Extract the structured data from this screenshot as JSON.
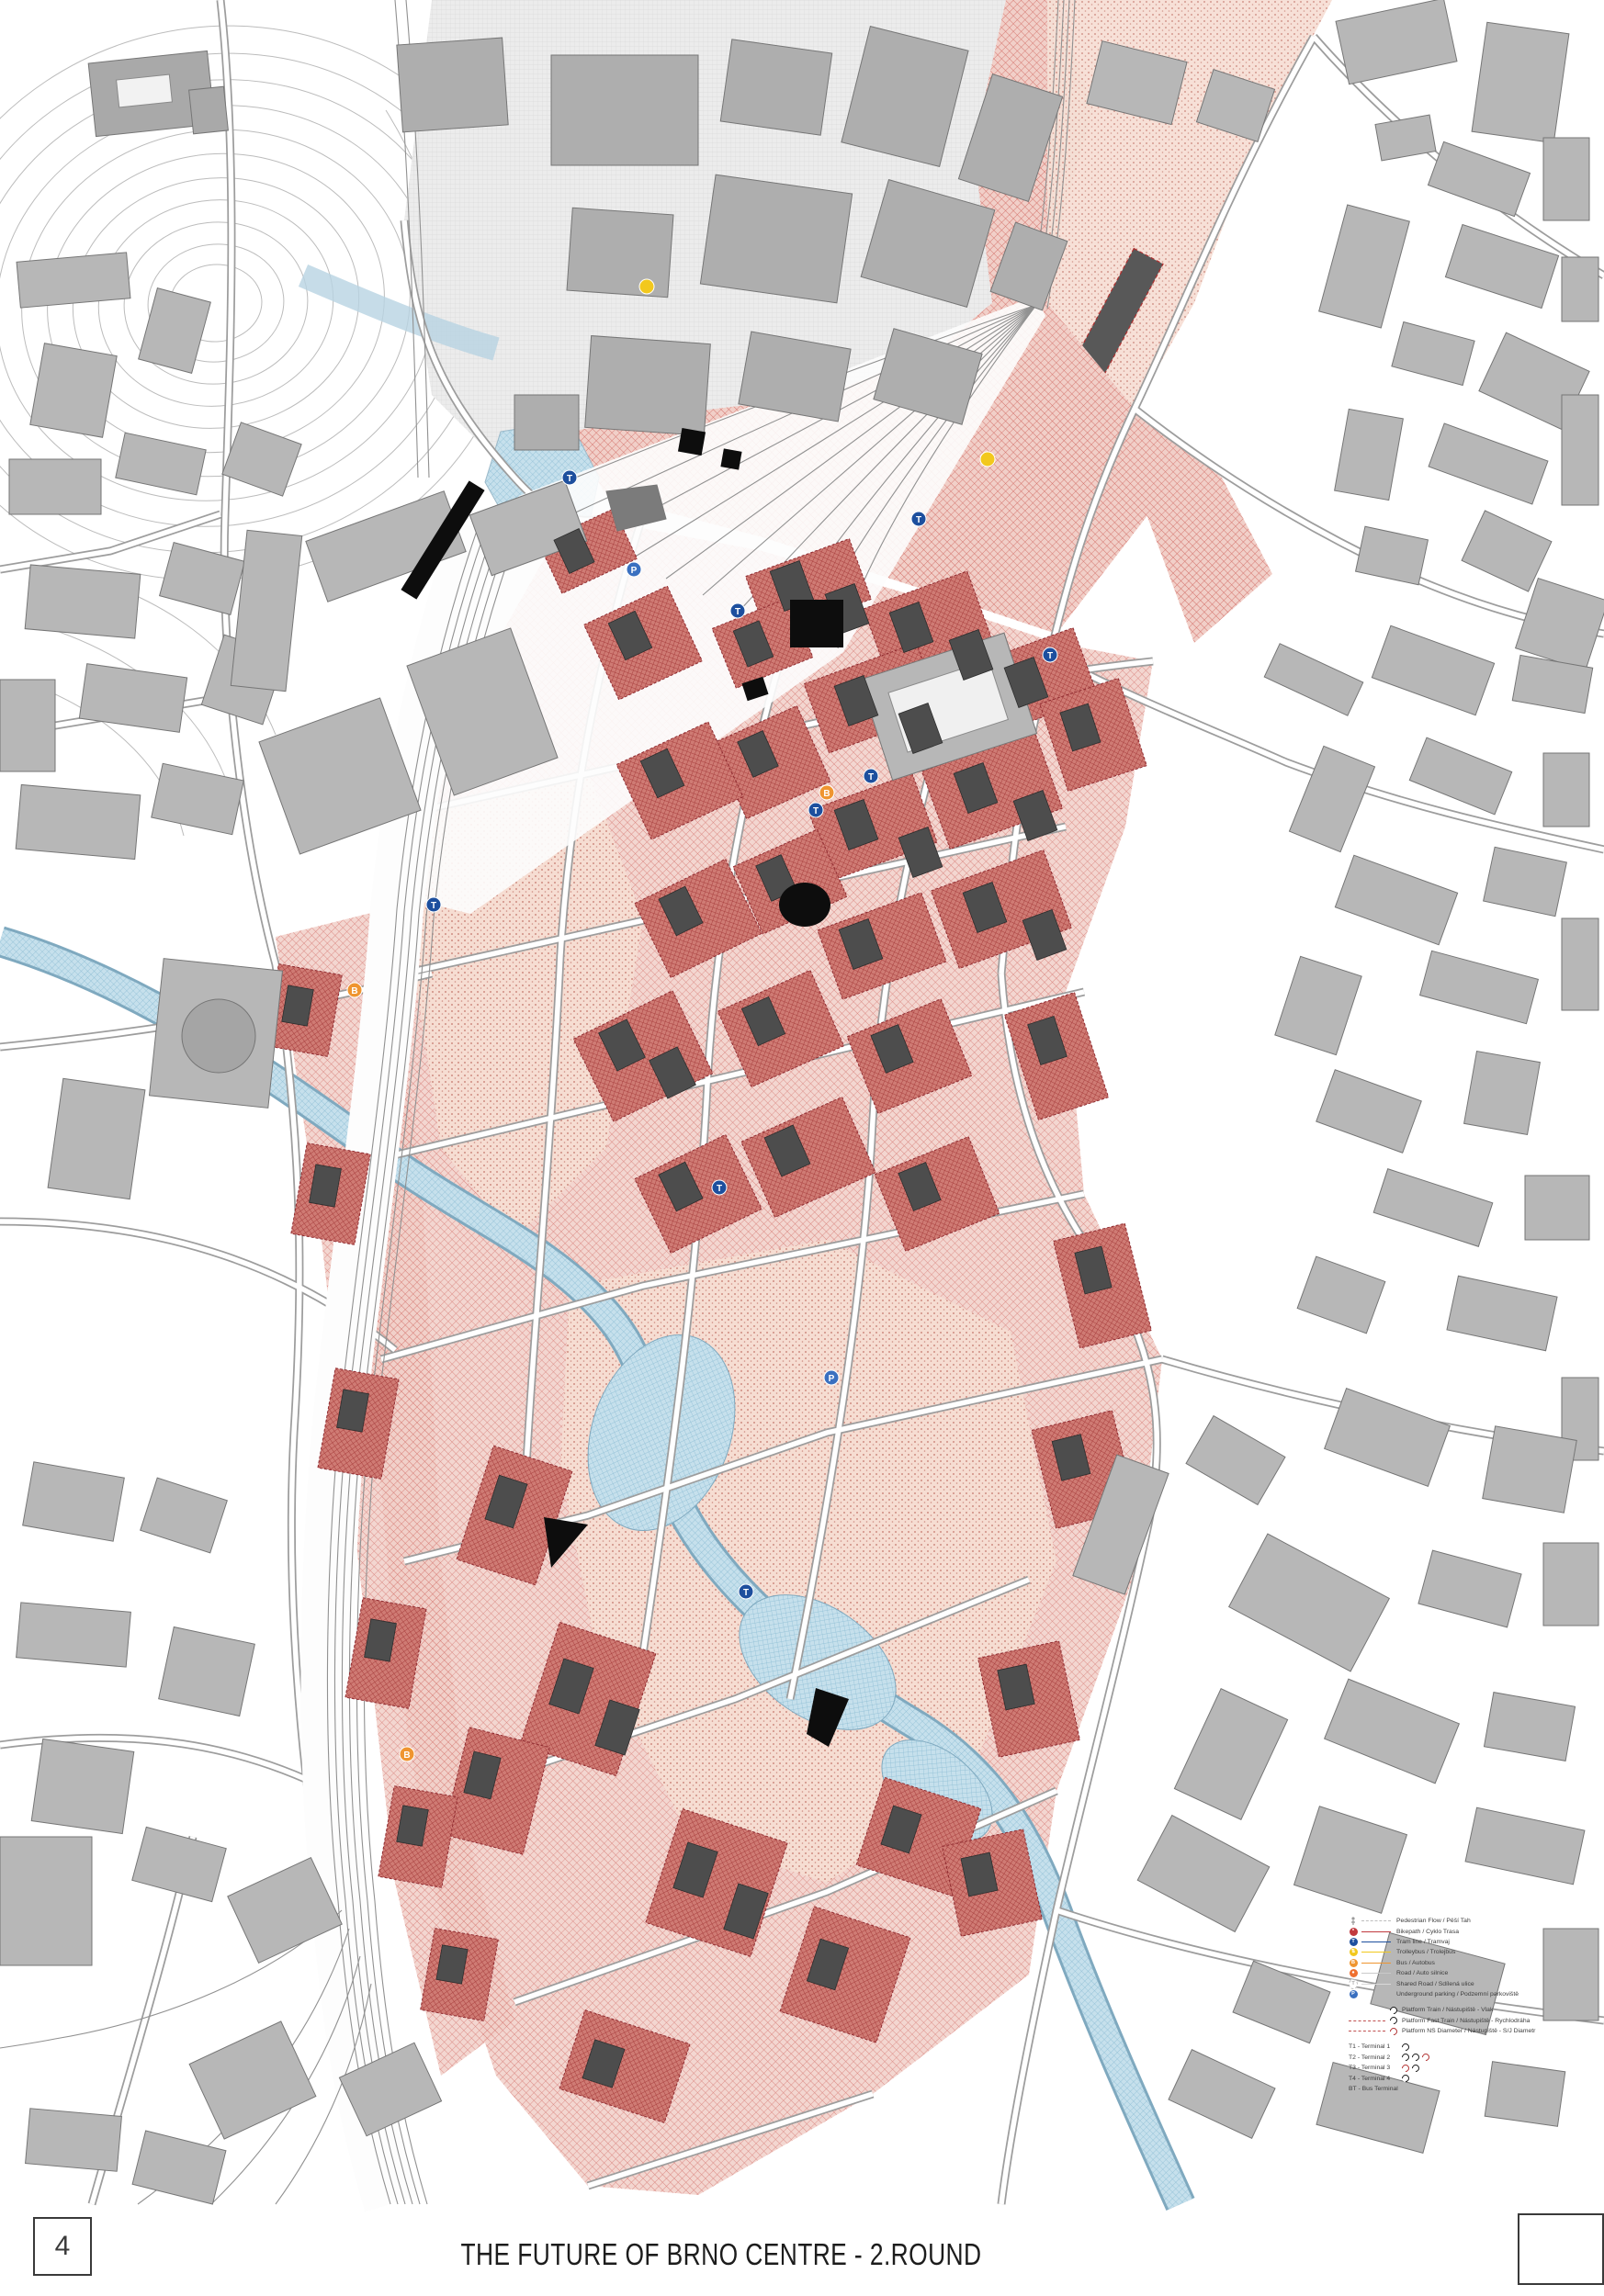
{
  "footer": {
    "page_number": "4",
    "title": "THE FUTURE OF BRNO CENTRE - 2.ROUND"
  },
  "map": {
    "description": "Masterplan of Brno centre: grey existing city, red new development corridor along relocated railway, river Svratka in blue",
    "transit_stops": {
      "tram": "T",
      "bus": "B",
      "parking": "P"
    },
    "palette": {
      "existing_building": "#b7b7b7",
      "new_building": "#4d4d4d",
      "landmark_building": "#0d0d0d",
      "development_hatch": "#d4736c",
      "dense_block": "#a83f3e",
      "park_pink": "#f6ddd2",
      "water": "#8cbdd4",
      "tram_blue": "#1d4f9e",
      "trolleybus_yellow": "#f2c81d",
      "bus_orange": "#ef9530",
      "bike_crimson": "#c13a3f",
      "parking_blue": "#3a70c0"
    }
  },
  "legend": {
    "route_items": [
      {
        "icon": "pedestrian-icon",
        "label": "Pedestrian Flow / Pěší Tah",
        "line_color": "#bdbdbd",
        "line_style": "dashed"
      },
      {
        "icon": "bike-icon",
        "label": "Bikepath / Cyklo Trasa",
        "line_color": "#c13a3f",
        "line_style": "solid"
      },
      {
        "icon": "tram-icon",
        "label": "Tram line / Tramvaj",
        "line_color": "#1d4f9e",
        "line_style": "solid"
      },
      {
        "icon": "trolleybus-icon",
        "label": "Trolleybus / Trolejbus",
        "line_color": "#f2c81d",
        "line_style": "solid"
      },
      {
        "icon": "bus-icon",
        "label": "Bus / Autobus",
        "line_color": "#ef9530",
        "line_style": "solid"
      },
      {
        "icon": "road-icon",
        "label": "Road / Auto silnice",
        "line_color": "#c9c9c9",
        "line_style": "solid"
      },
      {
        "icon": "shared-road-icon",
        "label": "Shared Road / Sdílená ulice",
        "line_color": "#d8d8d8",
        "line_style": "solid"
      },
      {
        "icon": "parking-icon",
        "label": "Underground parking / Podzemní parkoviště",
        "line_color": "",
        "line_style": "none"
      }
    ],
    "platform_items": [
      {
        "icon": "platform-train-icon",
        "label": "Platform Train / Nástupiště - Vlak"
      },
      {
        "icon": "platform-fast-train-icon",
        "label": "Platform Fast Train / Nástupiště - Rychlodráha"
      },
      {
        "icon": "platform-ns-icon",
        "label": "Platform NS Diameter / Nástupiště - S/J Diametr"
      }
    ],
    "terminal_items": [
      {
        "label": "T1 - Terminal 1"
      },
      {
        "label": "T2 - Terminal 2"
      },
      {
        "label": "T3 - Terminal 3"
      },
      {
        "label": "T4 - Terminal 4"
      },
      {
        "label": "BT - Bus Terminal"
      }
    ]
  }
}
